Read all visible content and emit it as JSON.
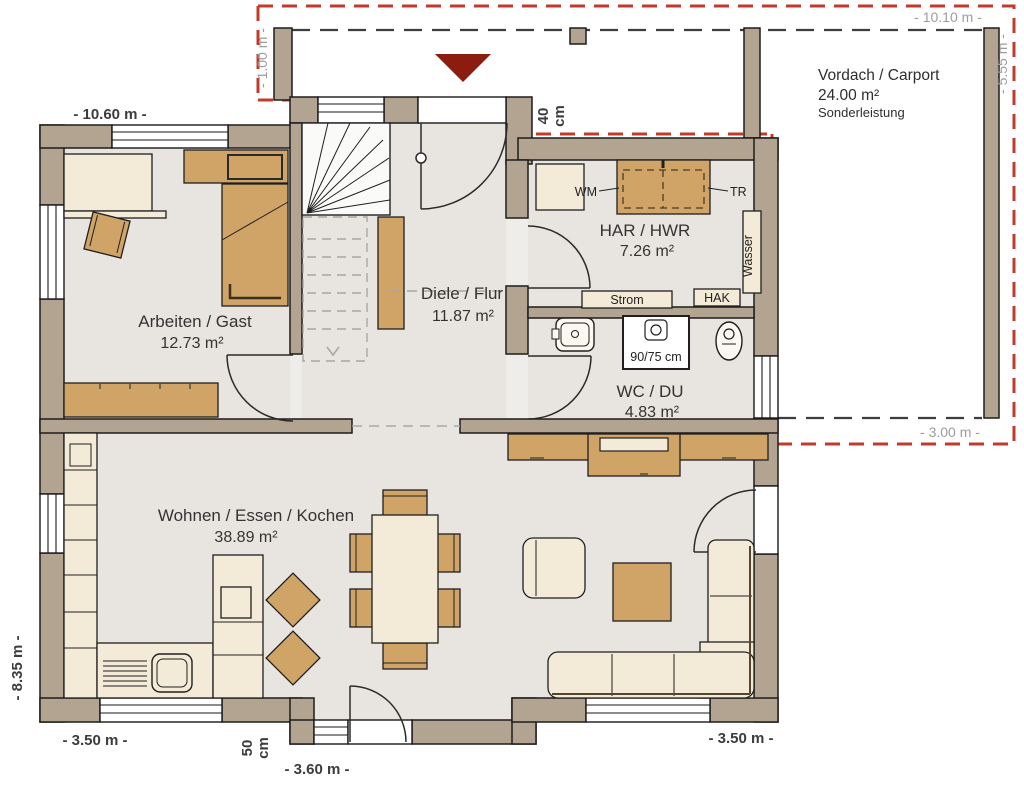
{
  "carport": {
    "label": "Vordach / Carport",
    "area": "24.00 m²",
    "note": "Sonderleistung"
  },
  "rooms": {
    "arbeiten": {
      "name": "Arbeiten / Gast",
      "area": "12.73 m²"
    },
    "diele": {
      "name": "Diele / Flur",
      "area": "11.87 m²"
    },
    "har": {
      "name": "HAR / HWR",
      "area": "7.26 m²"
    },
    "wc": {
      "name": "WC / DU",
      "area": "4.83 m²"
    },
    "wohnen": {
      "name": "Wohnen / Essen / Kochen",
      "area": "38.89 m²"
    }
  },
  "dimensions": {
    "carport_top": "- 10.10 m -",
    "carport_left": "- 1.00 m -",
    "carport_right": "- 5.55 m -",
    "carport_bottom": "- 3.00 m -",
    "house_top": "- 10.60 m -",
    "house_left": "- 8.35 m -",
    "bottom_left": "- 3.50 m -",
    "bay_width": "- 3.60 m -",
    "bay_depth": {
      "value": "50",
      "unit": "cm"
    },
    "entry_depth": {
      "value": "40",
      "unit": "cm"
    },
    "bottom_right": "- 3.50 m -"
  },
  "fixtures": {
    "wm": "WM",
    "tr": "TR",
    "strom": "Strom",
    "hak": "HAK",
    "wasser": "Wasser",
    "shower": "90/75 cm"
  },
  "colors": {
    "wall": "#b3a492",
    "floor": "#e8e5e1",
    "wood": "#cfa466",
    "cream": "#f3ead8",
    "carport_dash": "#c23b2a",
    "entry_arrow": "#8c1b10"
  }
}
